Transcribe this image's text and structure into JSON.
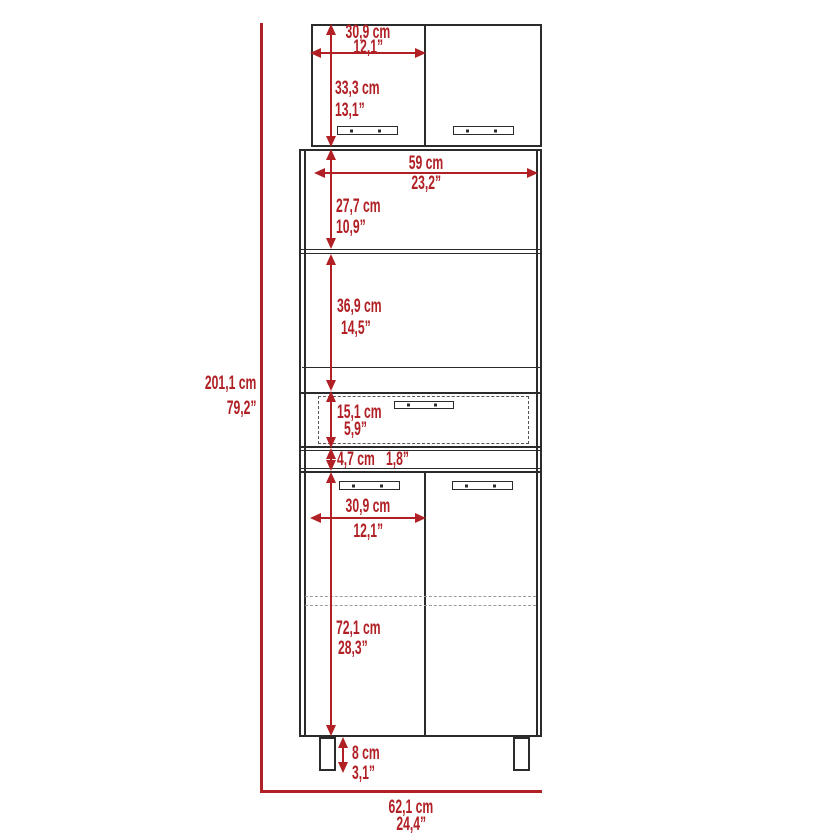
{
  "colors": {
    "dimension_red": "#b02025",
    "outline_dark": "#2b2b2b",
    "dashed_gray": "#9c9c9c"
  },
  "dims": {
    "overall_height": {
      "cm": "201,1 cm",
      "in": "79,2”"
    },
    "overall_width": {
      "cm": "62,1 cm",
      "in": "24,4”"
    },
    "top_door_width": {
      "cm": "30,9 cm",
      "in": "12,1”"
    },
    "top_cabinet_height": {
      "cm": "33,3 cm",
      "in": "13,1”"
    },
    "hutch_width": {
      "cm": "59 cm",
      "in": "23,2”"
    },
    "open_shelf_height": {
      "cm": "27,7 cm",
      "in": "10,9”"
    },
    "microwave_space_height": {
      "cm": "36,9 cm",
      "in": "14,5”"
    },
    "drawer_height": {
      "cm": "15,1 cm",
      "in": "5,9”"
    },
    "rail_height": {
      "cm": "4,7 cm",
      "in": "1,8”"
    },
    "bottom_door_width": {
      "cm": "30,9 cm",
      "in": "12,1”"
    },
    "bottom_cabinet_height": {
      "cm": "72,1 cm",
      "in": "28,3”"
    },
    "leg_height": {
      "cm": "8 cm",
      "in": "3,1”"
    }
  }
}
